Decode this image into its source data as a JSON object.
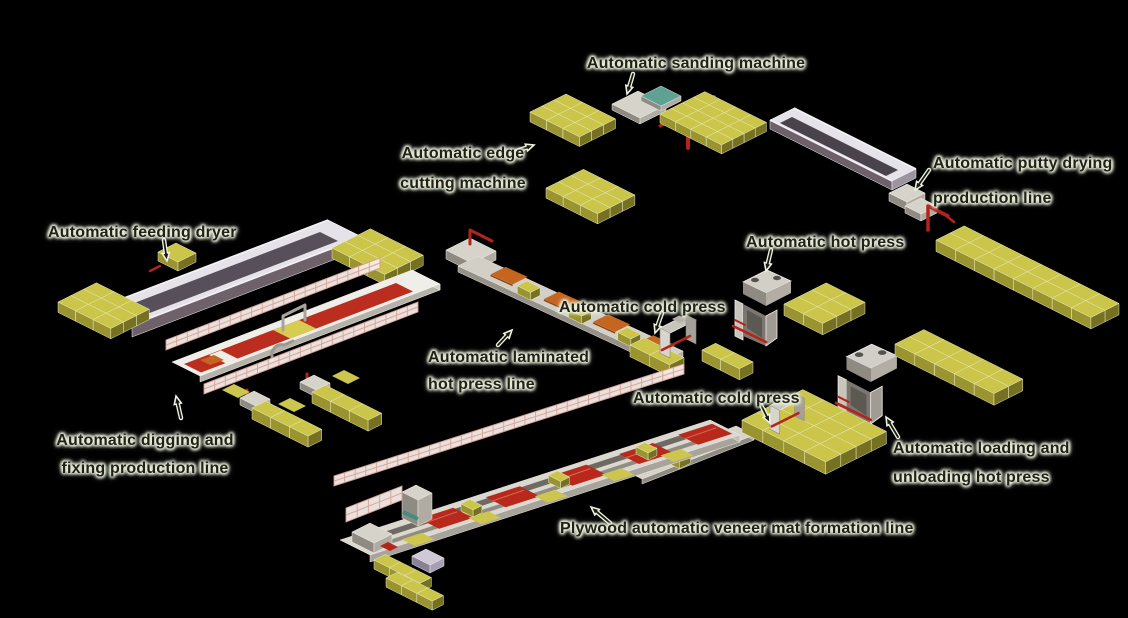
{
  "diagram": {
    "title": "Plywood production line diagram",
    "background_color": "#000000",
    "colors": {
      "block_yellow_top": "#cbc549",
      "block_yellow_side": "#9a9430",
      "accent_red": "#b3241a",
      "carpet_red": "#bb2d1e",
      "machine_gray": "#b0aca4",
      "fence_pink": "#f5e9e4",
      "label_text": "#23201a",
      "label_halo": "#e6eed6"
    },
    "labels": {
      "sanding": {
        "text": "Automatic sanding machine"
      },
      "edge_cutting": {
        "line1": "Automatic edge",
        "line2": "cutting machine"
      },
      "putty_drying": {
        "line1": "Automatic putty drying",
        "line2": "production line"
      },
      "feeding_dryer": {
        "text": "Automatic feeding dryer"
      },
      "hot_press": {
        "text": "Automatic hot press"
      },
      "cold_press_1": {
        "text": "Automatic cold press"
      },
      "laminated": {
        "line1": "Automatic laminated",
        "line2": "hot press line"
      },
      "cold_press_2": {
        "text": "Automatic cold press"
      },
      "digging_fixing": {
        "line1": "Automatic digging and",
        "line2": "fixing production line"
      },
      "loading_unloading": {
        "line1": "Automatic loading and",
        "line2": "unloading hot press"
      },
      "veneer_mat": {
        "text": "Plywood automatic veneer mat formation line"
      }
    }
  }
}
